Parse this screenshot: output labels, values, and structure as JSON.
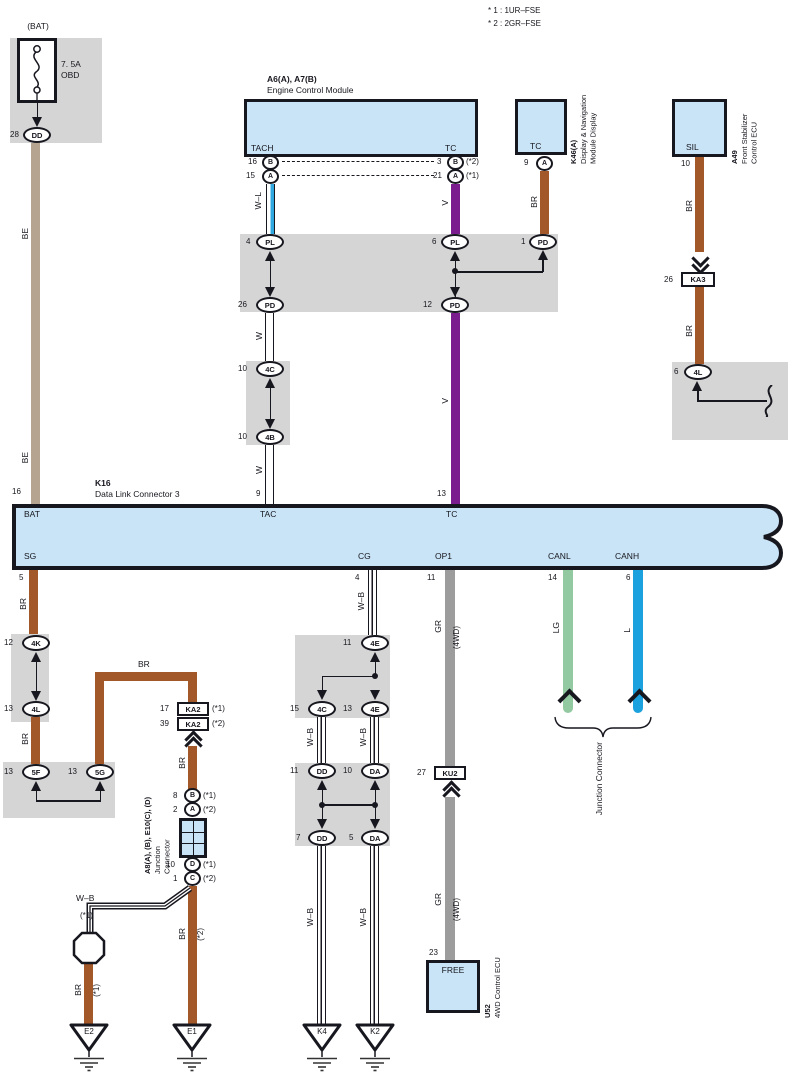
{
  "colors": {
    "ink": "#17171F",
    "be": "#B5A48F",
    "br": "#A3582A",
    "v": "#7A1B8E",
    "gr": "#9C9C9C",
    "lg": "#92C9A1",
    "l": "#1BA2DE",
    "wl": "#2FA8E0",
    "blue_box": "#C9E4F6",
    "shade": "#D5D5D5"
  },
  "notes": {
    "line1": "* 1 : 1UR–FSE",
    "line2": "* 2 : 2GR–FSE"
  },
  "fuse": {
    "bat": "(BAT)",
    "rating": "7. 5A",
    "name": "OBD",
    "pin": "28",
    "term": "DD",
    "wire_a": "BE",
    "wire_b": "BE",
    "k16_pin": "16"
  },
  "ecm": {
    "code": "A6(A), A7(B)",
    "name": "Engine Control Module",
    "tach": "TACH",
    "tc": "TC",
    "pin16": "16",
    "b1": "B",
    "pin15": "15",
    "a1": "A",
    "pin3": "3",
    "b2": "B",
    "n2": "(*2)",
    "pin21": "21",
    "a2": "A",
    "n1": "(*1)",
    "wl": "W–L",
    "v": "V"
  },
  "nav": {
    "term": "TC",
    "pin": "9",
    "a": "A",
    "code": "K46(A)",
    "name1": "Display & Navigation",
    "name2": "Module Display",
    "br": "BR"
  },
  "stab": {
    "term": "SIL",
    "pin": "10",
    "br1": "BR",
    "br2": "BR",
    "ka3_pin": "26",
    "ka3": "KA3",
    "code": "A49",
    "name1": "Front Stabilizer",
    "name2": "Control ECU",
    "pin4l": "6",
    "t4l": "4L"
  },
  "band": {
    "p4": "4",
    "pl1": "PL",
    "p26": "26",
    "pd1": "PD",
    "p6": "6",
    "pl2": "PL",
    "p12": "12",
    "pd2": "PD",
    "p1": "1",
    "pd3": "PD"
  },
  "wchain": {
    "w1": "W",
    "p10a": "10",
    "t4c": "4C",
    "p10b": "10",
    "t4b": "4B",
    "w2": "W",
    "pin9": "9"
  },
  "vchain": {
    "v": "V",
    "pin13": "13"
  },
  "k16": {
    "code": "K16",
    "name": "Data Link Connector 3",
    "pin16": "16",
    "bat": "BAT",
    "tac": "TAC",
    "tc": "TC",
    "sg": "SG",
    "cg": "CG",
    "op1": "OP1",
    "canl": "CANL",
    "canh": "CANH",
    "p5": "5",
    "p4": "4",
    "p11": "11",
    "p14": "14",
    "p6": "6"
  },
  "sg": {
    "br1": "BR",
    "p12": "12",
    "t4k": "4K",
    "p13a": "13",
    "t4l": "4L",
    "br2": "BR",
    "p13b": "13",
    "t5f": "5F",
    "p13c": "13",
    "t5g": "5G",
    "br3": "BR",
    "p17": "17",
    "ka2a": "KA2",
    "n1a": "(*1)",
    "p39": "39",
    "ka2b": "KA2",
    "n2a": "(*2)",
    "br4": "BR",
    "p8": "8",
    "tb": "B",
    "n1b": "(*1)",
    "p2": "2",
    "ta": "A",
    "n2b": "(*2)",
    "code": "A8(A), (B), E10(C), (D)",
    "name1": "Junction",
    "name2": "Connector",
    "p10": "10",
    "td": "D",
    "n1c": "(*1)",
    "p1": "1",
    "tc": "C",
    "n2c": "(*2)",
    "wb": "W–B",
    "wb_n": "(*1)",
    "br5": "BR",
    "br5_n": "(*2)",
    "br6": "BR",
    "br6_n": "(*1)",
    "e2": "E2",
    "e1": "E1"
  },
  "cg": {
    "wb0": "W–B",
    "p11a": "11",
    "t4e1": "4E",
    "p15": "15",
    "t4c": "4C",
    "p13": "13",
    "t4e2": "4E",
    "wb1": "W–B",
    "wb2": "W–B",
    "p11b": "11",
    "tdd1": "DD",
    "p10": "10",
    "tda1": "DA",
    "p7": "7",
    "tdd2": "DD",
    "p5": "5",
    "tda2": "DA",
    "wb3": "W–B",
    "wb4": "W–B",
    "k4": "K4",
    "k2": "K2"
  },
  "op1": {
    "gr1": "GR",
    "gr1n": "(4WD)",
    "p27": "27",
    "ku2": "KU2",
    "gr2": "GR",
    "gr2n": "(4WD)",
    "p23": "23",
    "term": "FREE",
    "code": "U52",
    "name": "4WD Control ECU"
  },
  "can": {
    "lg": "LG",
    "l": "L",
    "label": "Junction Connector"
  }
}
